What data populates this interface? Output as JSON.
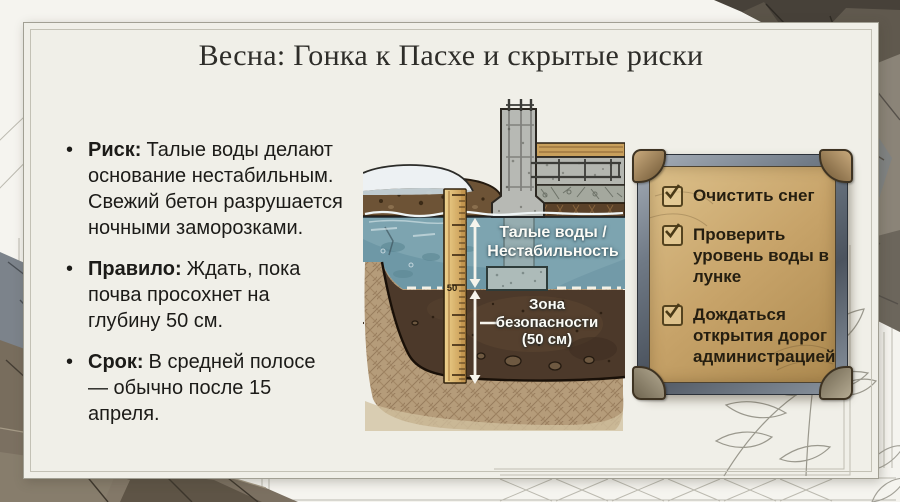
{
  "title": "Весна: Гонка к Пасхе и скрытые риски",
  "bullets": [
    {
      "label": "Риск:",
      "text": "Талые воды делают основание нестабильным. Свежий бетон разрушается ночными заморозками."
    },
    {
      "label": "Правило:",
      "text": "Ждать, пока почва просохнет на глубину 50 см."
    },
    {
      "label": "Срок:",
      "text": "В средней полосе — обычно после 15 апреля."
    }
  ],
  "diagram": {
    "water_label_line1": "Талые воды /",
    "water_label_line2": "Нестабильность",
    "zone_label_line1": "Зона",
    "zone_label_line2": "безопасности",
    "zone_label_line3": "(50 см)",
    "ruler_mark": "50"
  },
  "checklist": {
    "items": [
      {
        "label": "Очистить снег",
        "checked": true
      },
      {
        "label": "Проверить уровень воды в лунке",
        "checked": true
      },
      {
        "label": "Дождаться открытия дорог администрацией",
        "checked": true
      }
    ]
  },
  "colors": {
    "paper_bg": "#f5f4ef",
    "card_bg": "#f0efe8",
    "title_text": "#2e2d29",
    "body_text": "#1c1b18",
    "water": "#7da4b0",
    "soil_dark": "#4c392a",
    "topsoil": "#6d5336",
    "soil_hatch": "#b59c7a",
    "concrete": "#b7b9b4",
    "wood_plank": "#c9a05c",
    "ruler_wood": "#dcb36a",
    "parchment": "#c7a369",
    "frame_metal": "#707a86",
    "bronze_cap": "#8a6b42",
    "checkbox_brown": "#54431f",
    "label_text": "#ffffff",
    "rock_gray": "#8b8478",
    "rock_dark": "#474139"
  }
}
